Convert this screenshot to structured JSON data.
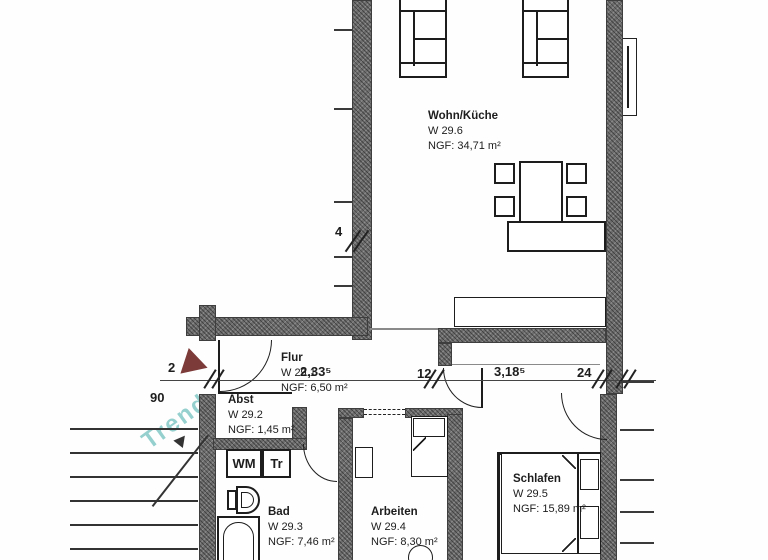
{
  "plan": {
    "type": "apartment-floor-plan",
    "rooms": {
      "wohnkueche": {
        "name": "Wohn/Küche",
        "code": "W 29.6",
        "area": "NGF: 34,71 m²"
      },
      "flur": {
        "name": "Flur",
        "code": "W 29.1",
        "area": "NGF: 6,50 m²"
      },
      "abst": {
        "name": "Abst",
        "code": "W 29.2",
        "area": "NGF: 1,45 m²"
      },
      "bad": {
        "name": "Bad",
        "code": "W 29.3",
        "area": "NGF: 7,46 m²"
      },
      "arbeiten": {
        "name": "Arbeiten",
        "code": "W 29.4",
        "area": "NGF: 8,30 m²"
      },
      "schlafen": {
        "name": "Schlafen",
        "code": "W 29.5",
        "area": "NGF: 15,89 m²"
      }
    },
    "appliances": {
      "washing_machine": "WM",
      "dryer": "Tr"
    },
    "dimensions": {
      "entry": "2",
      "stair": "90",
      "flur_width": "2,33⁵",
      "wall_a": "12",
      "corridor_width": "3,18⁵",
      "wall_b": "24",
      "window": "4"
    },
    "watermark": {
      "text": "Trend"
    },
    "colors": {
      "wall_fill": "#6e6e6e",
      "line": "#1d1d1d",
      "entry_arrow": "#7c3a38",
      "watermark": "#2fa3a0"
    }
  }
}
